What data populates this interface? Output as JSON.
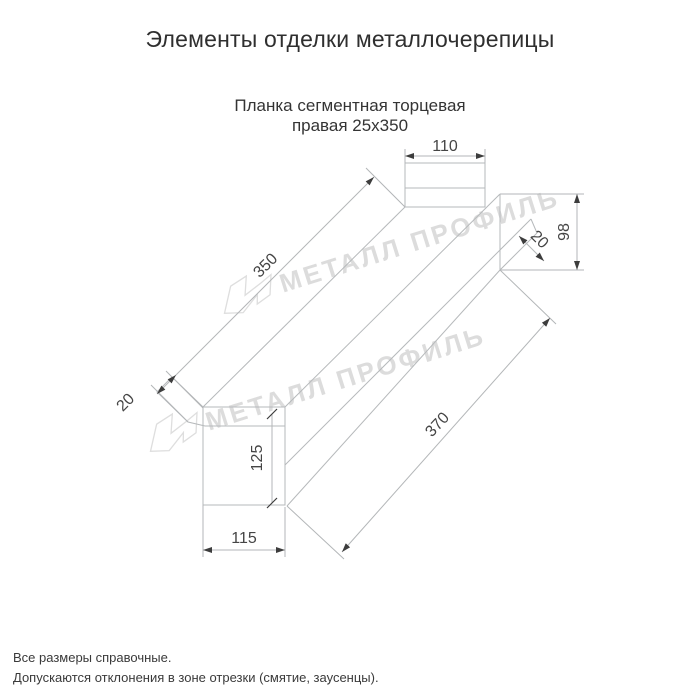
{
  "header": {
    "title": "Элементы отделки металлочерепицы"
  },
  "product": {
    "subtitle_line1": "Планка сегментная торцевая",
    "subtitle_line2": "правая 25х350"
  },
  "dimensions": {
    "top_width": "110",
    "right_height": "98",
    "right_hem": "20",
    "edge_top_length": "350",
    "left_hem": "20",
    "end_height": "125",
    "end_width": "115",
    "edge_bottom_length": "370"
  },
  "watermark": {
    "text": "МЕТАЛЛ ПРОФИЛЬ",
    "logo": "metall-profil-arrow-logo",
    "color": "#dcdcdc"
  },
  "footer": {
    "note1": "Все размеры справочные.",
    "note2": "Допускаются отклонения в зоне отрезки (смятие, заусенцы)."
  },
  "colors": {
    "background": "#ffffff",
    "drawing_line": "#b6b9bb",
    "dimension_text": "#454545",
    "title_text": "#2f2f2f"
  }
}
